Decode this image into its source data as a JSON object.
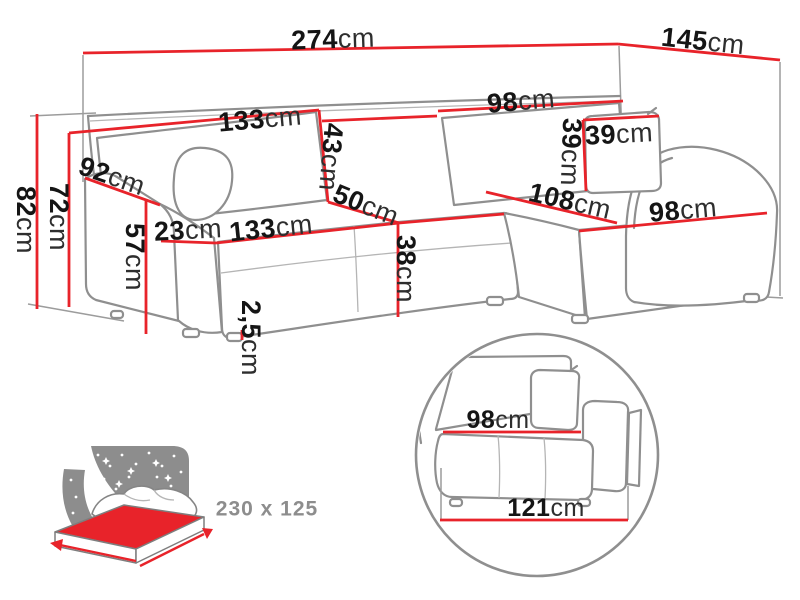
{
  "colors": {
    "accent_red": "#e8232a",
    "outline_gray": "#8f8f8f",
    "text_dark": "#151515",
    "muted_gray": "#8d8d8d"
  },
  "dimensions": {
    "total_width": {
      "v": "274",
      "u": "cm"
    },
    "total_depth": {
      "v": "145",
      "u": "cm"
    },
    "backrest_left_width": {
      "v": "133",
      "u": "cm"
    },
    "backrest_height": {
      "v": "43",
      "u": "cm"
    },
    "backrest_right_width": {
      "v": "98",
      "u": "cm"
    },
    "cushion_width": {
      "v": "39",
      "u": "cm"
    },
    "cushion_height": {
      "v": "39",
      "u": "cm"
    },
    "side_depth": {
      "v": "92",
      "u": "cm"
    },
    "total_height": {
      "v": "82",
      "u": "cm"
    },
    "backrest_top_height": {
      "v": "72",
      "u": "cm"
    },
    "armrest_height": {
      "v": "57",
      "u": "cm"
    },
    "armrest_width": {
      "v": "23",
      "u": "cm"
    },
    "seat_width": {
      "v": "133",
      "u": "cm"
    },
    "seat_depth": {
      "v": "50",
      "u": "cm"
    },
    "seat_height": {
      "v": "38",
      "u": "cm"
    },
    "chaise_length": {
      "v": "108",
      "u": "cm"
    },
    "chaise_width": {
      "v": "98",
      "u": "cm"
    },
    "leg_height": {
      "v": "2,5",
      "u": "cm"
    }
  },
  "sleeping_area": {
    "label": "230 x 125"
  },
  "detail_view": {
    "seat_depth": {
      "v": "98",
      "u": "cm"
    },
    "base_width": {
      "v": "121",
      "u": "cm"
    }
  }
}
